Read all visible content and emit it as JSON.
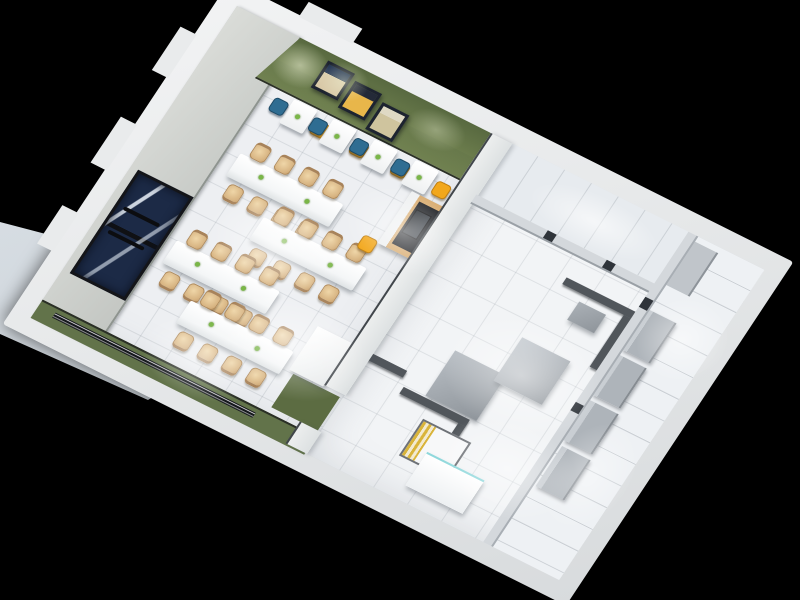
{
  "scene": {
    "name": "3d-cutaway-floor-plan-render",
    "description": "Top-down 3D render of a small restaurant: dining hall with long tables and a kitchen block, on black background",
    "background_color": "#000000",
    "rooms": [
      "dining-area",
      "kitchen",
      "kitchen-corridor",
      "storage-room"
    ]
  },
  "palette": {
    "exterior_wall": "#e8eaeb",
    "entrance_wall_gray": "#cdd0cc",
    "accent_green_wall": "#6b7c4c",
    "door_navy": "#1c2a46",
    "floor_white": "#edeff2",
    "wood_chair": "#d8b583",
    "blue_chair": "#2f6d92",
    "yellow_chair": "#f2a71b",
    "equipment_gray": "#b7bdc3",
    "cap_dark_gray": "#51565b",
    "counter_yellow_stripe": "#d9b43a",
    "counter_glass_cyan": "#8fd8dc",
    "pavement": "#ccd3d9"
  },
  "layout": {
    "notches": [
      {
        "x": -36,
        "y": 44,
        "w": 18,
        "h": 52
      },
      {
        "x": -36,
        "y": 152,
        "w": 18,
        "h": 55
      },
      {
        "x": -36,
        "y": 258,
        "w": 18,
        "h": 46
      },
      {
        "x": 58,
        "y": -36,
        "w": 60,
        "h": 18
      }
    ],
    "posters": [
      {
        "x": 52,
        "y": 8,
        "tone": "linear-gradient(180deg,#1f3150 0 35%,#d9c9a8 35%)"
      },
      {
        "x": 86,
        "y": 14,
        "tone": "linear-gradient(180deg,#242a38 0 30%,#e8b64a 30%)"
      },
      {
        "x": 121,
        "y": 21,
        "tone": "linear-gradient(180deg,#dfd9c4 0 30%,#cfc49e 30%)"
      }
    ],
    "wall_spots": [
      {
        "x": 2,
        "y": 2,
        "w": 58,
        "h": 46,
        "o": 0.55
      },
      {
        "x": 52,
        "y": 0,
        "w": 50,
        "h": 40,
        "o": 0.45
      },
      {
        "x": 150,
        "y": 2,
        "w": 62,
        "h": 40,
        "o": 0.35
      }
    ],
    "long_tables": [
      {
        "x": 85,
        "y": 131
      },
      {
        "x": 140,
        "y": 178
      },
      {
        "x": 80,
        "y": 238
      },
      {
        "x": 125,
        "y": 286
      }
    ],
    "wall_tables": [
      {
        "x": 100,
        "left": "blue",
        "right": "yellow"
      },
      {
        "x": 144,
        "left": "blue",
        "right": "yellow"
      },
      {
        "x": 190,
        "left": "blue",
        "right": "yellow"
      },
      {
        "x": 236,
        "left": "blue",
        "right": "yellow"
      }
    ],
    "equip_blocks": [
      {
        "x": 375,
        "y": 212,
        "w": 57,
        "h": 54,
        "c": "#b7bdc3"
      },
      {
        "x": 424,
        "y": 170,
        "w": 54,
        "h": 52,
        "c": "#c3c9cf"
      },
      {
        "x": 452,
        "y": 112,
        "w": 30,
        "h": 22,
        "c": "#aab0b6"
      }
    ],
    "caps": [
      {
        "x": 428,
        "y": 96,
        "w": 77,
        "h": 8
      },
      {
        "x": 497,
        "y": 104,
        "w": 8,
        "h": 62
      },
      {
        "x": 352,
        "y": 268,
        "w": 74,
        "h": 8
      },
      {
        "x": 418,
        "y": 276,
        "w": 8,
        "h": 70
      },
      {
        "x": 306,
        "y": 252,
        "w": 40,
        "h": 8
      }
    ],
    "wall_slots": [
      {
        "x": 386,
        "y": 62,
        "w": 10,
        "h": 9
      },
      {
        "x": 452,
        "y": 62,
        "w": 10,
        "h": 9
      },
      {
        "x": 505,
        "y": 78,
        "w": 9,
        "h": 12
      },
      {
        "x": 505,
        "y": 204,
        "w": 9,
        "h": 10
      }
    ],
    "shelves": [
      {
        "x": 514,
        "y": 88
      },
      {
        "x": 514,
        "y": 142
      },
      {
        "x": 516,
        "y": 196
      },
      {
        "x": 518,
        "y": 250
      }
    ],
    "glows": [
      {
        "x": 95,
        "y": 150,
        "w": 140,
        "h": 100,
        "o": 0.55
      },
      {
        "x": 160,
        "y": 225,
        "w": 150,
        "h": 110,
        "o": 0.5
      },
      {
        "x": 205,
        "y": 85,
        "w": 120,
        "h": 85,
        "o": 0.5
      },
      {
        "x": 105,
        "y": 295,
        "w": 120,
        "h": 80,
        "o": 0.45
      },
      {
        "x": 350,
        "y": 6,
        "w": 140,
        "h": 55,
        "o": 0.6
      },
      {
        "x": 365,
        "y": 145,
        "w": 160,
        "h": 120,
        "o": 0.5
      },
      {
        "x": 415,
        "y": 245,
        "w": 140,
        "h": 100,
        "o": 0.45
      },
      {
        "x": 516,
        "y": 55,
        "w": 88,
        "h": 90,
        "o": 0.5
      },
      {
        "x": 518,
        "y": 205,
        "w": 80,
        "h": 120,
        "o": 0.4
      }
    ]
  }
}
